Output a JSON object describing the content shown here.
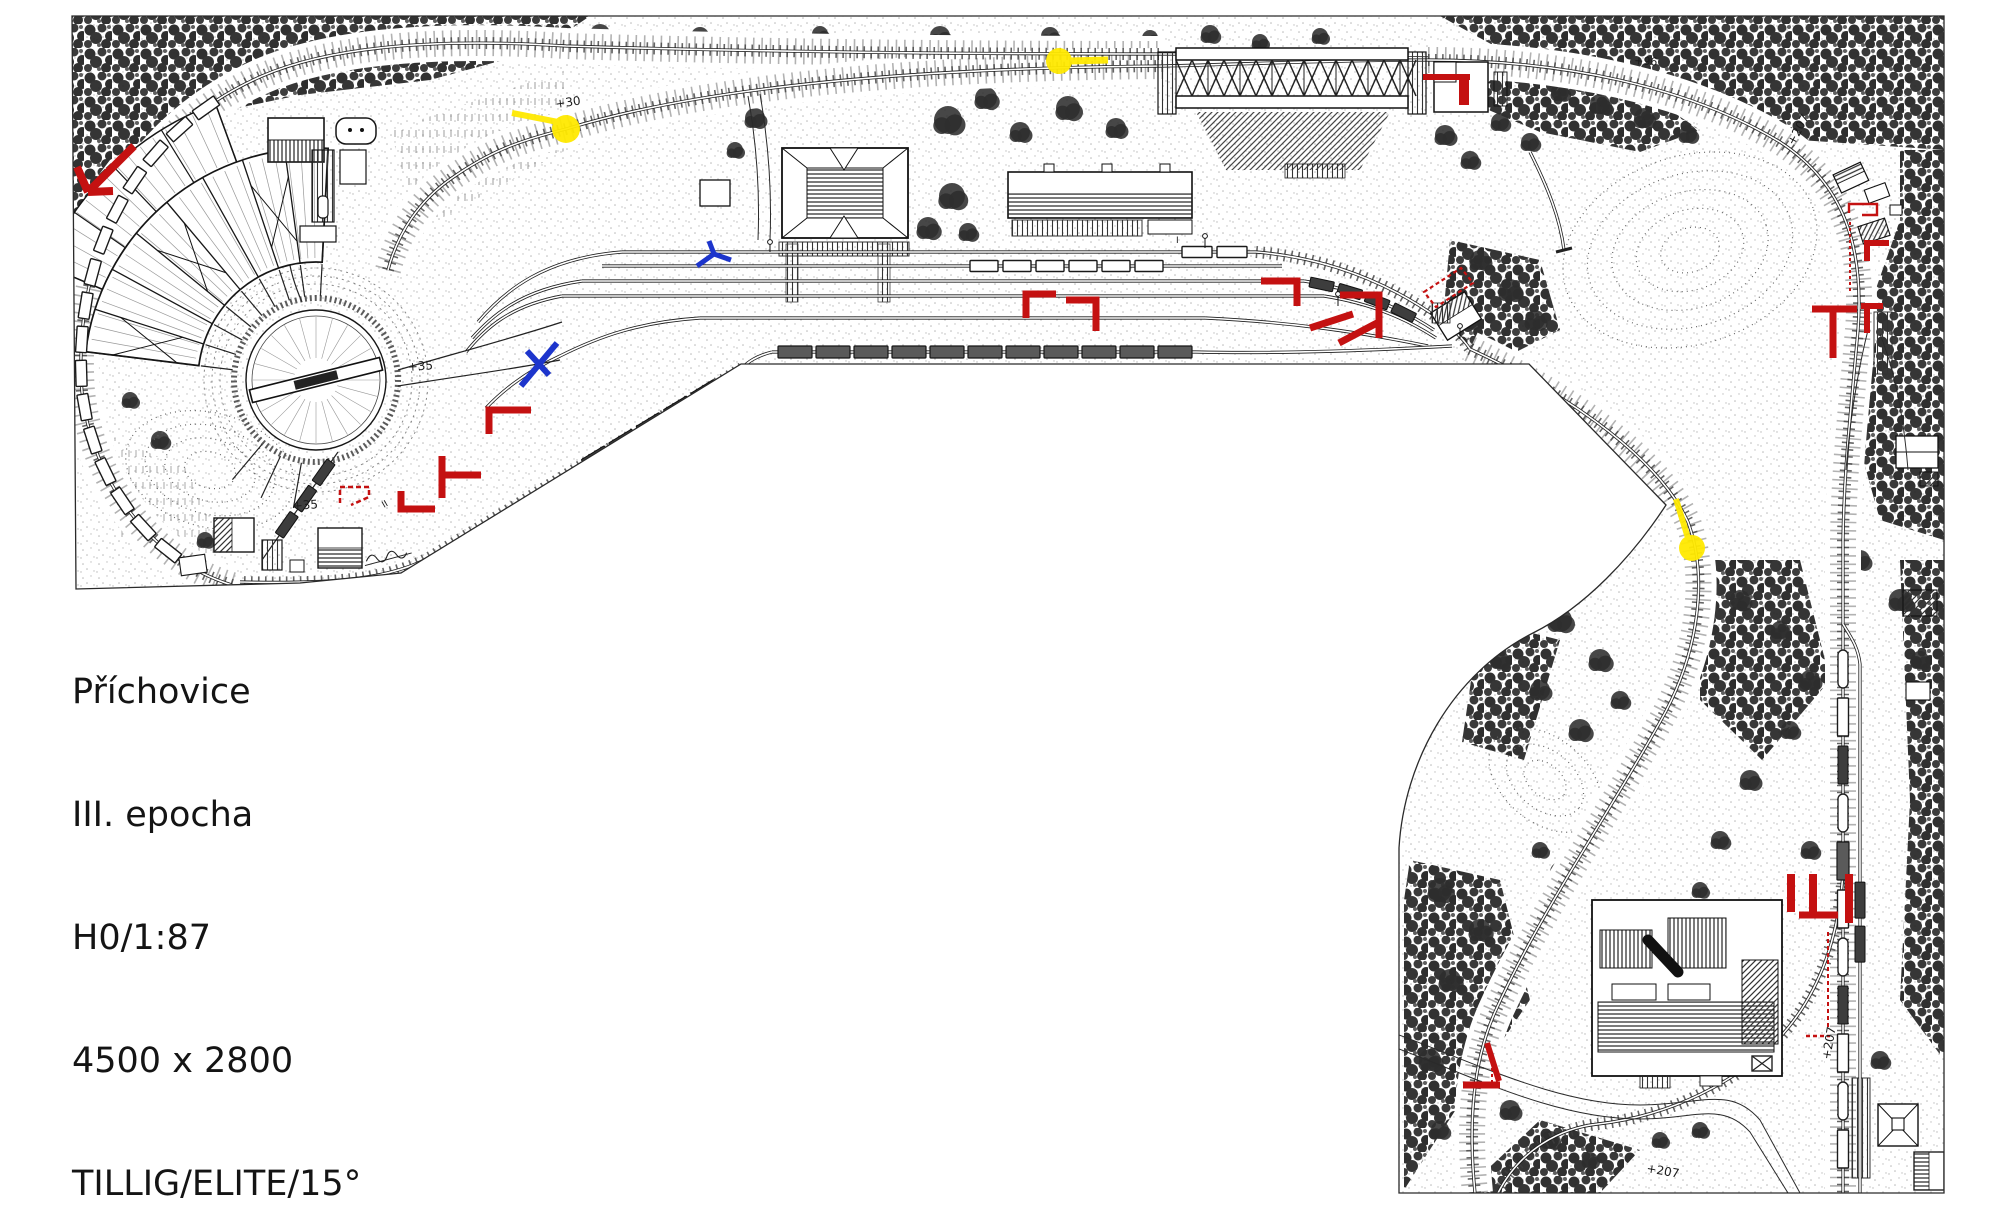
{
  "document": {
    "kind": "model-railway-track-plan",
    "title_block": {
      "lines": [
        "Příchovice",
        "III. epocha",
        "H0/1:87",
        "4500 x 2800",
        "TILLIG/ELITE/15°"
      ]
    },
    "plan_labels": {
      "grade_top_left": "+30",
      "elev_turntable_yard": "+35",
      "elev_depot_south": "+35",
      "elev_top_right": "+96",
      "elev_right_curve": "+207",
      "elev_right_south": "+207",
      "elev_bottom_road": "+207",
      "track_no_a": "II",
      "track_no_b": "I"
    },
    "annotation_colors": {
      "ink": "#1b1b1b",
      "correction_red": "#c41111",
      "note_blue": "#1d35cc",
      "highlight_yellow": "#ffe900"
    }
  }
}
